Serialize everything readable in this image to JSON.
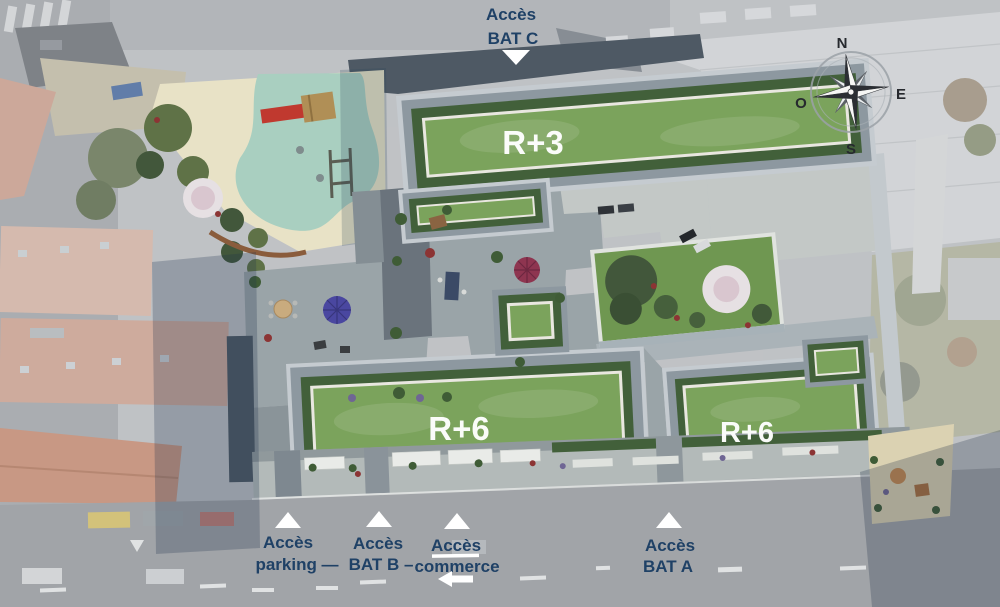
{
  "colors": {
    "label_navy": "#1f4166",
    "label_white": "#ffffff",
    "lawn_green": "#7ba35c",
    "hedge_green": "#42603a",
    "roof_slate": "#4e5964",
    "paver_gray": "#9aa4a8",
    "sand_beige": "#e8e2c6",
    "play_surface_teal": "#a9cfc0",
    "aerial_fade": "#bfc2c5"
  },
  "building_labels": {
    "r3": "R+3",
    "r6_main": "R+6",
    "r6_east": "R+6"
  },
  "access_labels": {
    "bat_c": {
      "line1": "Accès",
      "line2": "BAT C"
    },
    "parking": {
      "line1": "Accès",
      "line2": "parking —"
    },
    "bat_b": {
      "line1": "Accès",
      "line2": "BAT B –"
    },
    "commerce": {
      "line1": "Accès",
      "line2": "commerce"
    },
    "bat_a": {
      "line1": "Accès",
      "line2": "BAT A"
    }
  },
  "compass": {
    "north": "N",
    "east": "E",
    "south": "S",
    "west": "O"
  }
}
